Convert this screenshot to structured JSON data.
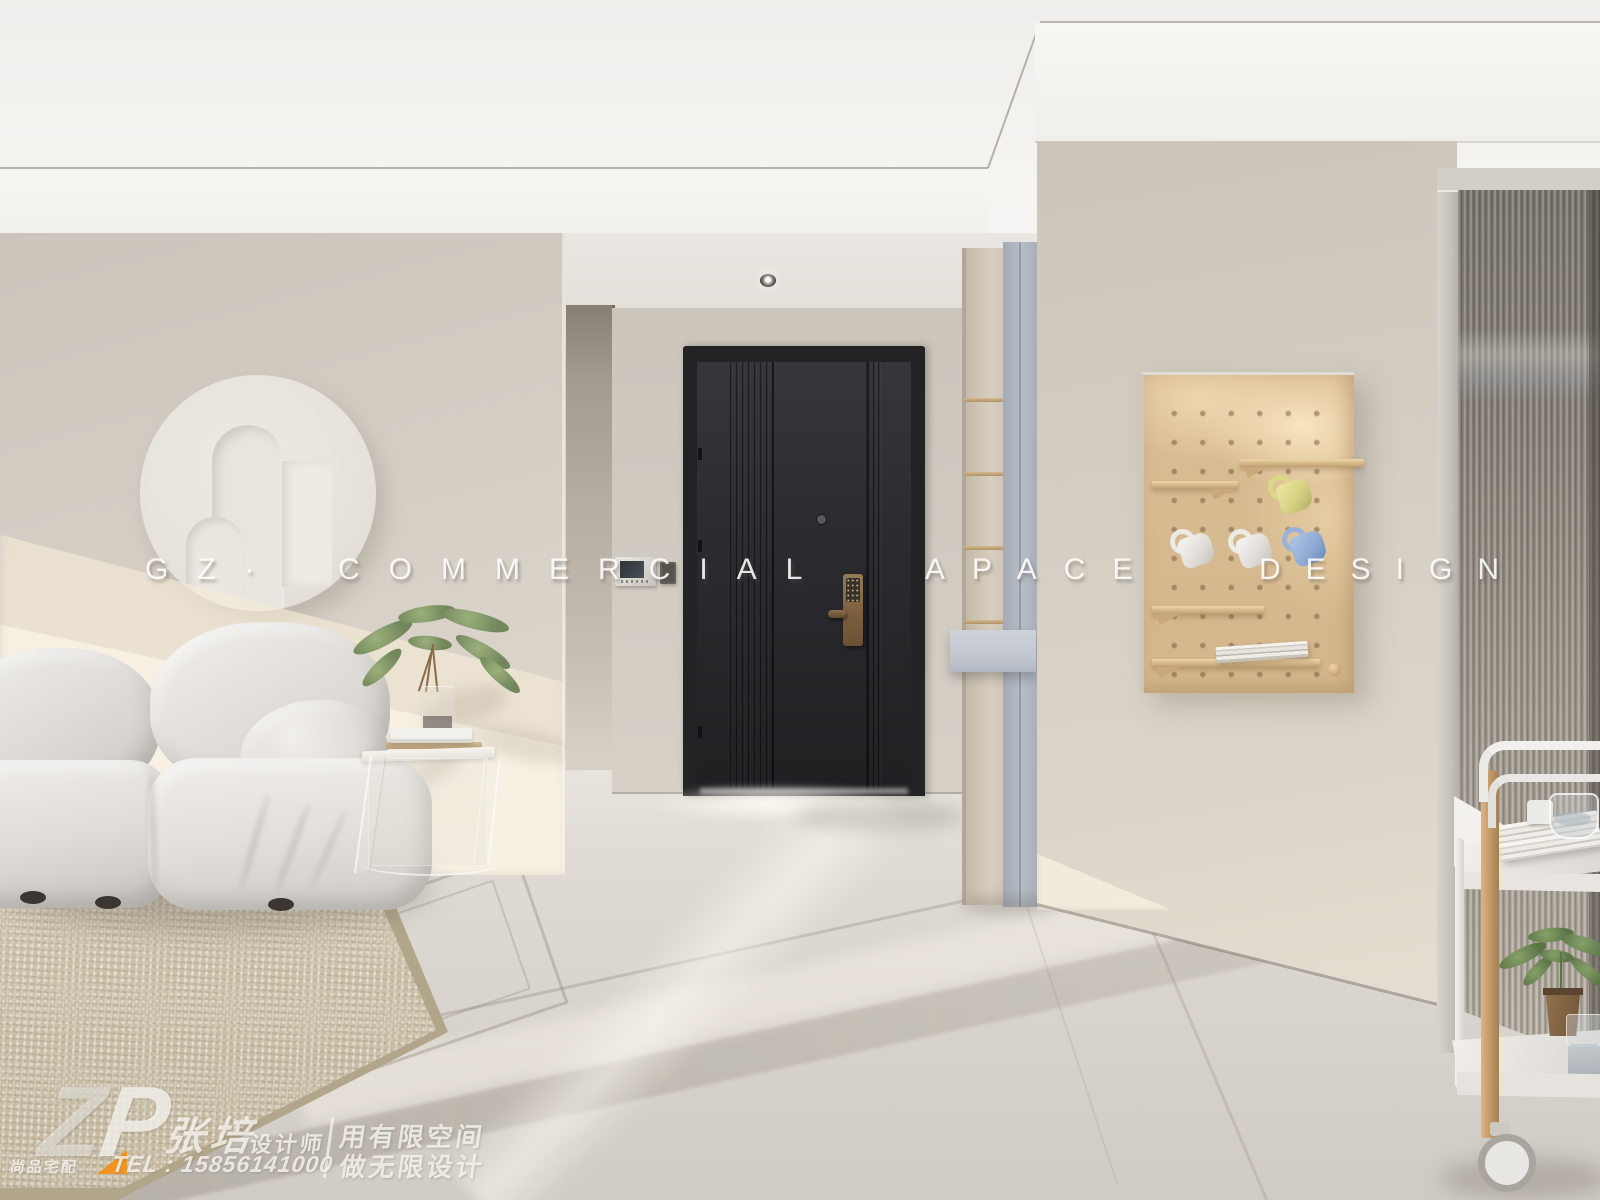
{
  "watermark": {
    "prefix": "GZ·",
    "word1": "COMMERCIAL",
    "word2": "APACE",
    "word3": "DESIGN"
  },
  "logo": {
    "brand_letter_z": "Z",
    "brand_letter_p": "P",
    "company": "尚品宅配",
    "designer_name": "张培",
    "designer_title": "设计师",
    "slogan_line1": "用有限空间",
    "slogan_line2": "做无限设计",
    "phone": "TEL : 15856141000"
  },
  "palette": {
    "accent_orange": "#f09423",
    "door_black": "#26262a",
    "lock_bronze": "#8a6d4a",
    "cabinet_blue_gray": "#b3b9c3",
    "pegboard_wood": "#d7ba90",
    "sofa_fabric": "#e4e1dc",
    "rug_beige": "#cdc3ac",
    "wall_greige": "#d3cdc4",
    "glass_gray": "#958f86",
    "mug_colors": [
      "#d6d282",
      "#e2dfda",
      "#e2dfda",
      "#8fabd4"
    ]
  },
  "scene_objects": [
    "recessed-ceiling",
    "downlight",
    "circle-wall-relief",
    "modular-sofa",
    "acrylic-side-table",
    "green-plant",
    "area-rug",
    "black-entry-door",
    "smart-lock",
    "video-intercom",
    "light-switch",
    "shoe-cabinet",
    "wood-pegboard",
    "hanging-mugs",
    "fluted-glass-partition",
    "serving-trolley"
  ]
}
